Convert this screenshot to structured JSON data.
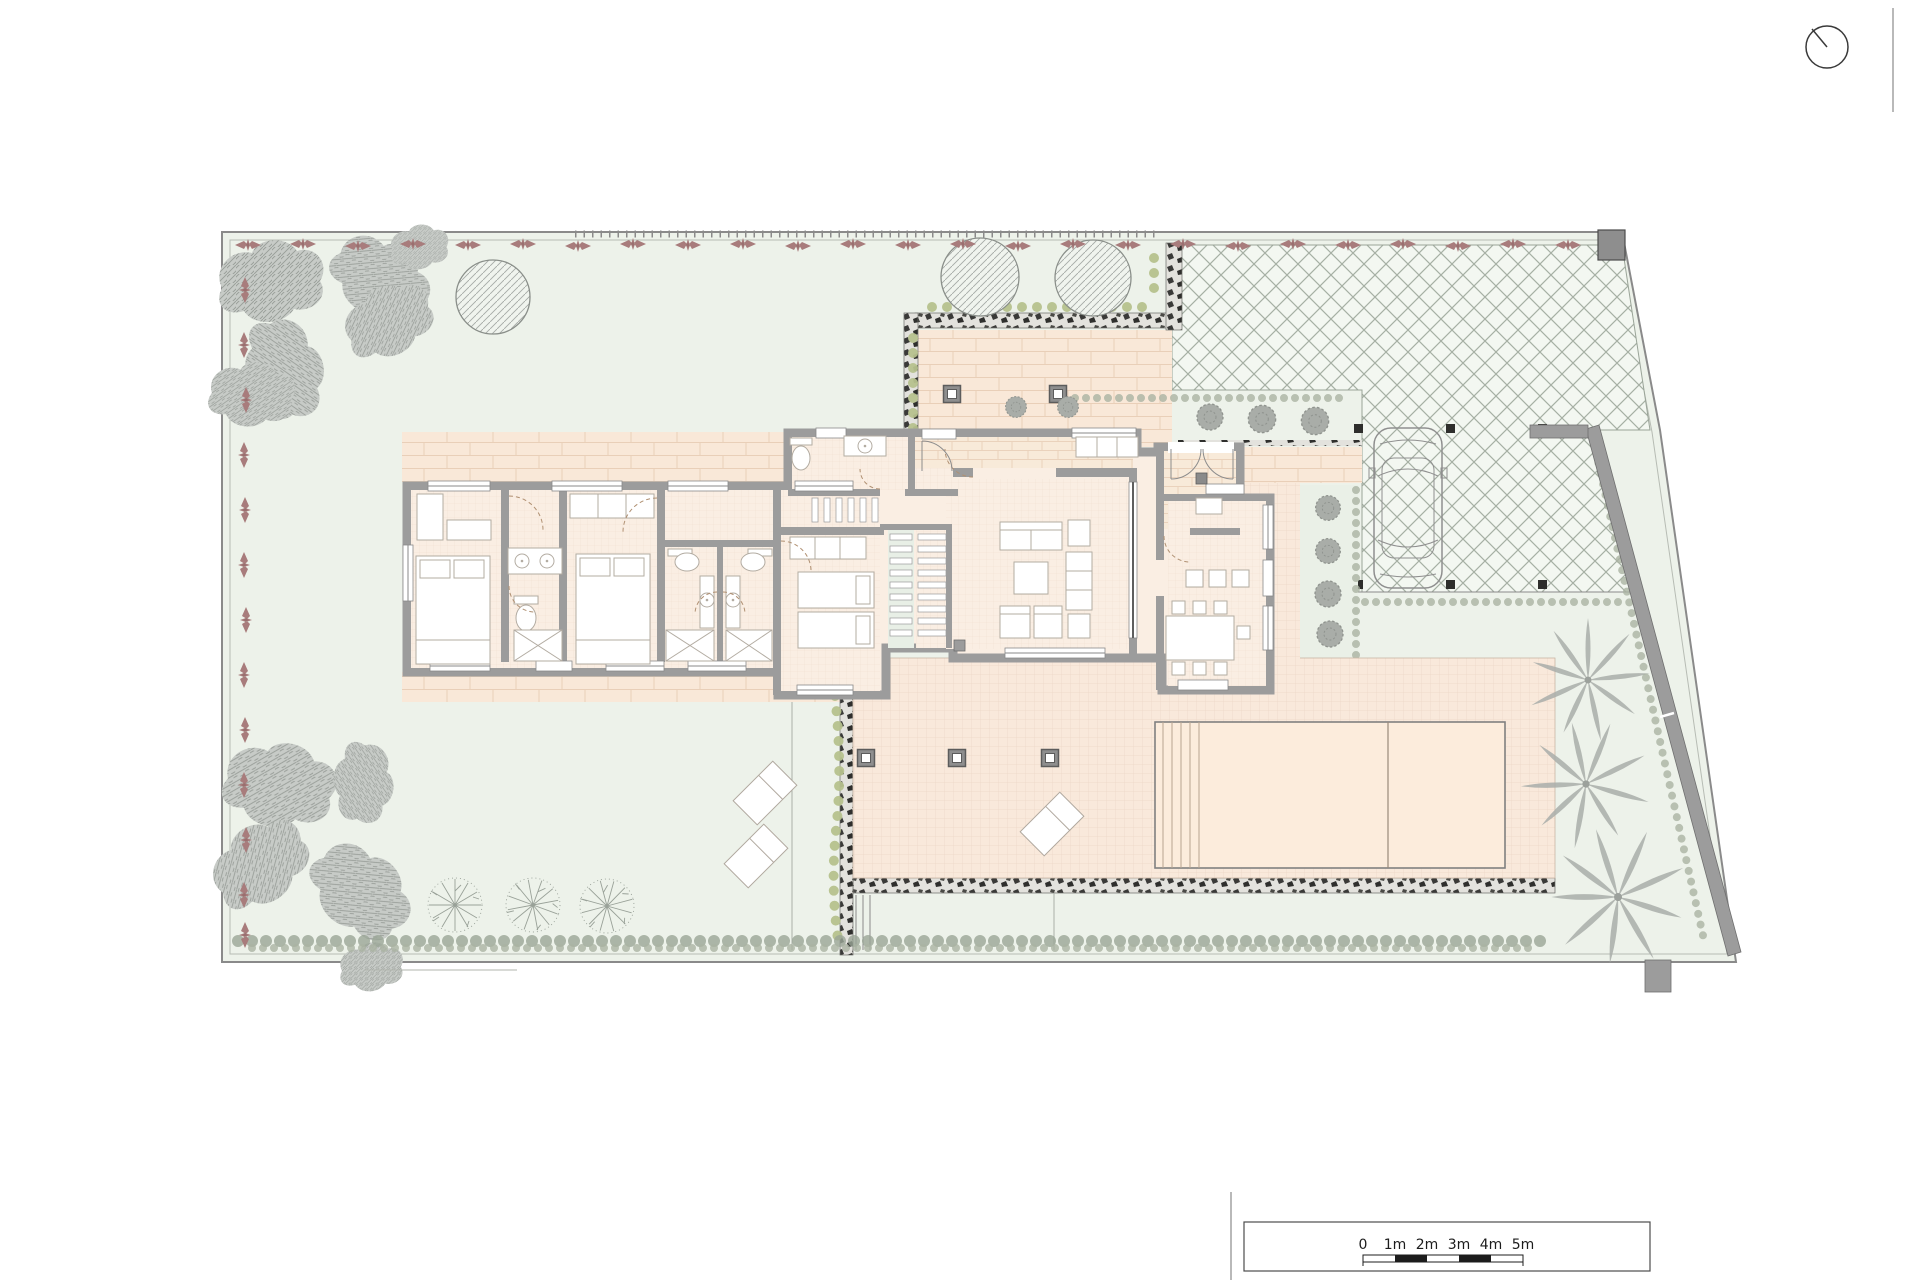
{
  "document": {
    "kind": "architectural-site-and-floor-plan",
    "sheet_color": "#ffffff"
  },
  "scale_bar": {
    "labels": [
      "0",
      "1m",
      "2m",
      "3m",
      "4m",
      "5m"
    ],
    "segment_meters": 1,
    "style": "alternating black and white segments"
  },
  "north_indicator": {
    "icon": "circle-with-bearing-needle"
  },
  "palette": {
    "grass": "#edf2ea",
    "paving_cream": "#f9e8d8",
    "room_floor": "#faeee3",
    "pool": "#fcecdc",
    "walls": "#9c9c9c",
    "boundary_line": "#8a8a8a",
    "crosshatch_line": "#a6b0a4",
    "tree_gray": "#c7cbc7",
    "border_flowers_red": "#a87c7c",
    "shrub_green": "#b6c18d",
    "stone_dark": "#3a3a38"
  },
  "site_features": [
    "property-boundary",
    "garden-lawn",
    "flower-border",
    "deciduous-trees",
    "round-hedge-trees",
    "palm-trees",
    "gravel-driveway",
    "parked-car",
    "entrance-courtyard",
    "entry-path",
    "planter-strip",
    "terrace",
    "swimming-pool",
    "pool-steps",
    "sun-loungers",
    "garden-lights",
    "perimeter-hedge",
    "retaining-wall",
    "gate-post"
  ],
  "house_rooms": [
    "bedroom-1",
    "bathroom-1",
    "bedroom-2",
    "bathroom-2",
    "bathroom-3",
    "bedroom-3",
    "guest-wc",
    "hall-corridor",
    "staircase",
    "living-room",
    "entry-vestibule",
    "dining-kitchen"
  ]
}
